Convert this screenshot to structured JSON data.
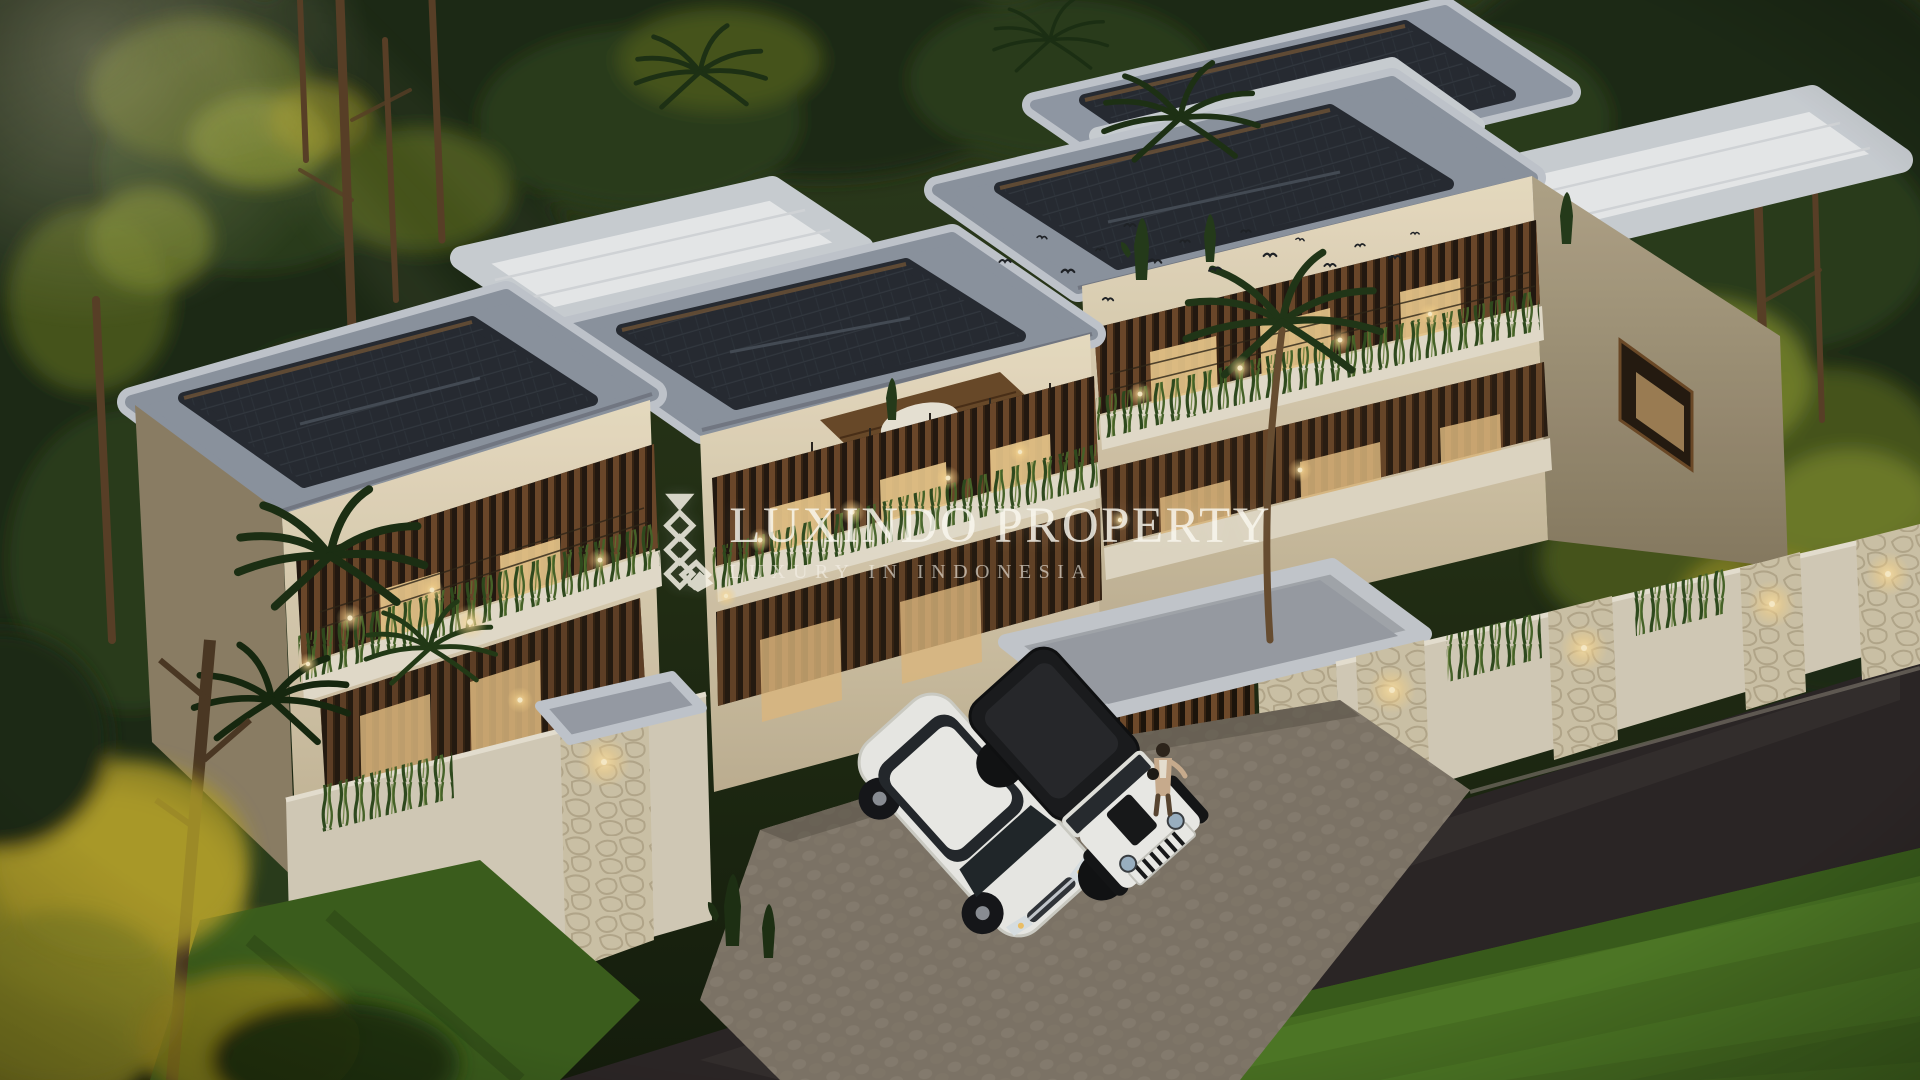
{
  "watermark": {
    "brand": "LUXINDO PROPERTY",
    "tagline": "LUXURY IN INDONESIA",
    "logo": "diamond-lattice L monogram",
    "text_color": "#f7f3e8"
  },
  "scene": {
    "type": "exterior architectural 3D render, aerial dusk view",
    "subject": "row of modern tropical two-storey villas with dark shingle hip roofs, white flat roofs and planted balconies",
    "environment": [
      "dense forest backdrop with sunlit golden patches",
      "palm trees and cacti",
      "hanging balcony greenery with warm string lights",
      "natural stone boundary walls with sconce lighting",
      "cobblestone driveway",
      "dark asphalt road",
      "bright green front lawn",
      "flock of birds above the white roof"
    ],
    "vehicles": [
      {
        "label": "white SUV",
        "position": "driveway"
      },
      {
        "label": "white jeep with black soft top",
        "position": "driveway"
      }
    ],
    "people": [
      {
        "label": "woman in beige outfit walking toward the entrance gate"
      }
    ],
    "lighting": "warm interior and landscape lighting at dusk",
    "palette": {
      "forest_dark": "#1c2a12",
      "forest_mid": "#2c3e1a",
      "forest_sunlit": "#8a9838",
      "roof_slab": "#9aa2ae",
      "roof_shingle": "#262b33",
      "roof_white": "#eef0f2",
      "wall_cream": "#e2d8c2",
      "timber": "#7a5130",
      "stone": "#d3c9b0",
      "lawn": "#4c7722",
      "road": "#2c2627",
      "glow_warm": "#ffd98f"
    }
  }
}
